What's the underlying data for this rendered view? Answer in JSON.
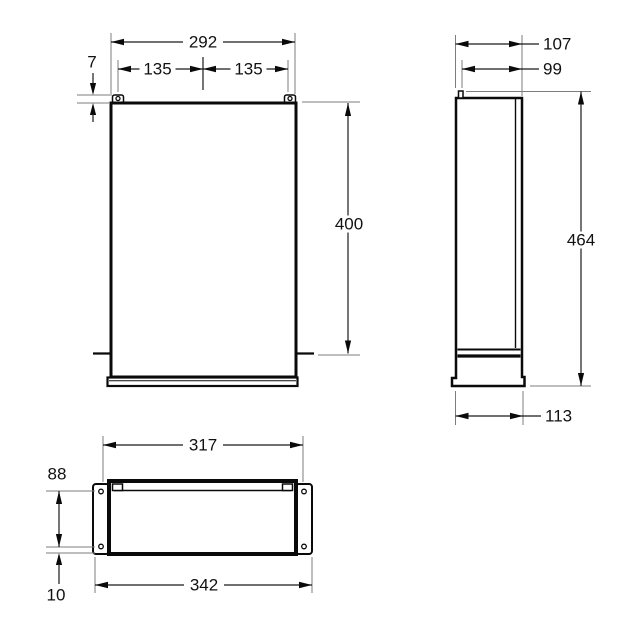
{
  "drawing": {
    "type": "technical-dimension-drawing",
    "units_shown": false,
    "front_view": {
      "overall_width": "292",
      "mount_hole_offset_left": "135",
      "mount_hole_offset_right": "135",
      "tab_height": "7",
      "body_height": "400"
    },
    "side_view": {
      "depth_total": "107",
      "depth_body": "99",
      "height_total": "464",
      "base_depth": "113"
    },
    "bottom_view": {
      "opening_width": "317",
      "overall_width": "342",
      "opening_height": "88",
      "flange_edge_offset": "10"
    },
    "colors": {
      "line": "#0a0a0a",
      "extension_line": "#7d7d7d",
      "background": "#ffffff"
    }
  }
}
